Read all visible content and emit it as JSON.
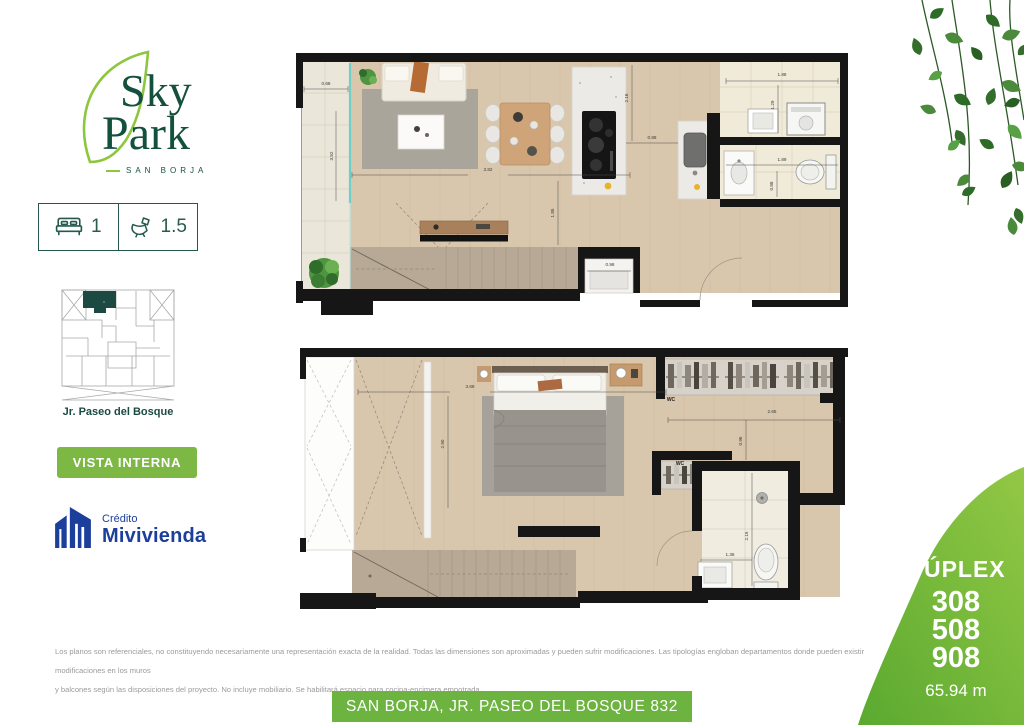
{
  "brand": {
    "name_line1": "Sky",
    "name_line2": "Park",
    "subtitle": "SAN BORJA"
  },
  "stats": {
    "bedrooms": "1",
    "bathrooms": "1.5"
  },
  "sitemap": {
    "street_label": "Jr. Paseo del Bosque"
  },
  "actions": {
    "vista_interna": "VISTA INTERNA"
  },
  "credito": {
    "line1": "Crédito",
    "line2": "Mivivienda"
  },
  "duplex_card": {
    "title": "DÚPLEX",
    "units": [
      "308",
      "508",
      "908"
    ],
    "area": "65.94 m"
  },
  "footer": {
    "disclaimer_line1": "Los planos son referenciales, no constituyendo necesariamente una representación exacta de la realidad. Todas las dimensiones son aproximadas y pueden sufrir modificaciones.  Las tipologías engloban departamentos donde pueden existir modificaciones en los muros",
    "disclaimer_line2": "y balcones según las disposiciones del proyecto. No incluye mobiliario. Se habilitará espacio para cocina-encimera empotrada.",
    "address_banner": "SAN BORJA, JR. PASEO DEL BOSQUE 832"
  },
  "colors": {
    "brand_dark_green": "#14503e",
    "leaf_green": "#8dc63f",
    "button_green": "#7cb843",
    "banner_green": "#6cb33f",
    "duplex_gradient_start": "#93c845",
    "duplex_gradient_end": "#5aa930",
    "mivivienda_blue": "#1d3f9c",
    "teal_dark": "#1c4a42",
    "wall_black": "#161616",
    "wood_floor": "#d9c7ad",
    "stair_wood": "#b7a996",
    "tile_light": "#f0ead9",
    "glass_teal": "#6ecfc9"
  },
  "floorplans": {
    "upper": {
      "dims": [
        {
          "t": "0.68",
          "x": 30,
          "y": 32,
          "r": 0
        },
        {
          "t": "3.52",
          "x": 37,
          "y": 103,
          "r": -90
        },
        {
          "t": "3.82",
          "x": 192,
          "y": 118,
          "r": 0
        },
        {
          "t": "1.85",
          "x": 258,
          "y": 160,
          "r": -90
        },
        {
          "t": "2.16",
          "x": 332,
          "y": 45,
          "r": -90
        },
        {
          "t": "0.88",
          "x": 356,
          "y": 86,
          "r": 0
        },
        {
          "t": "1.88",
          "x": 486,
          "y": 23,
          "r": 0
        },
        {
          "t": "1.29",
          "x": 478,
          "y": 52,
          "r": -90
        },
        {
          "t": "1.89",
          "x": 486,
          "y": 108,
          "r": 0
        },
        {
          "t": "0.88",
          "x": 477,
          "y": 133,
          "r": -90
        },
        {
          "t": "0.98",
          "x": 314,
          "y": 213,
          "r": 0
        }
      ]
    },
    "lower": {
      "dims": [
        {
          "t": "3.69",
          "x": 170,
          "y": 40,
          "r": 0
        },
        {
          "t": "2.90",
          "x": 144,
          "y": 96,
          "r": -90
        },
        {
          "t": "2.65",
          "x": 472,
          "y": 65,
          "r": 0
        },
        {
          "t": "0.96",
          "x": 442,
          "y": 93,
          "r": -90
        },
        {
          "t": "2.15",
          "x": 448,
          "y": 188,
          "r": -90
        },
        {
          "t": "1.36",
          "x": 430,
          "y": 208,
          "r": 0
        }
      ],
      "closet_labels": [
        {
          "t": "WC",
          "x": 371,
          "y": 53
        },
        {
          "t": "WC",
          "x": 380,
          "y": 117
        }
      ]
    }
  }
}
